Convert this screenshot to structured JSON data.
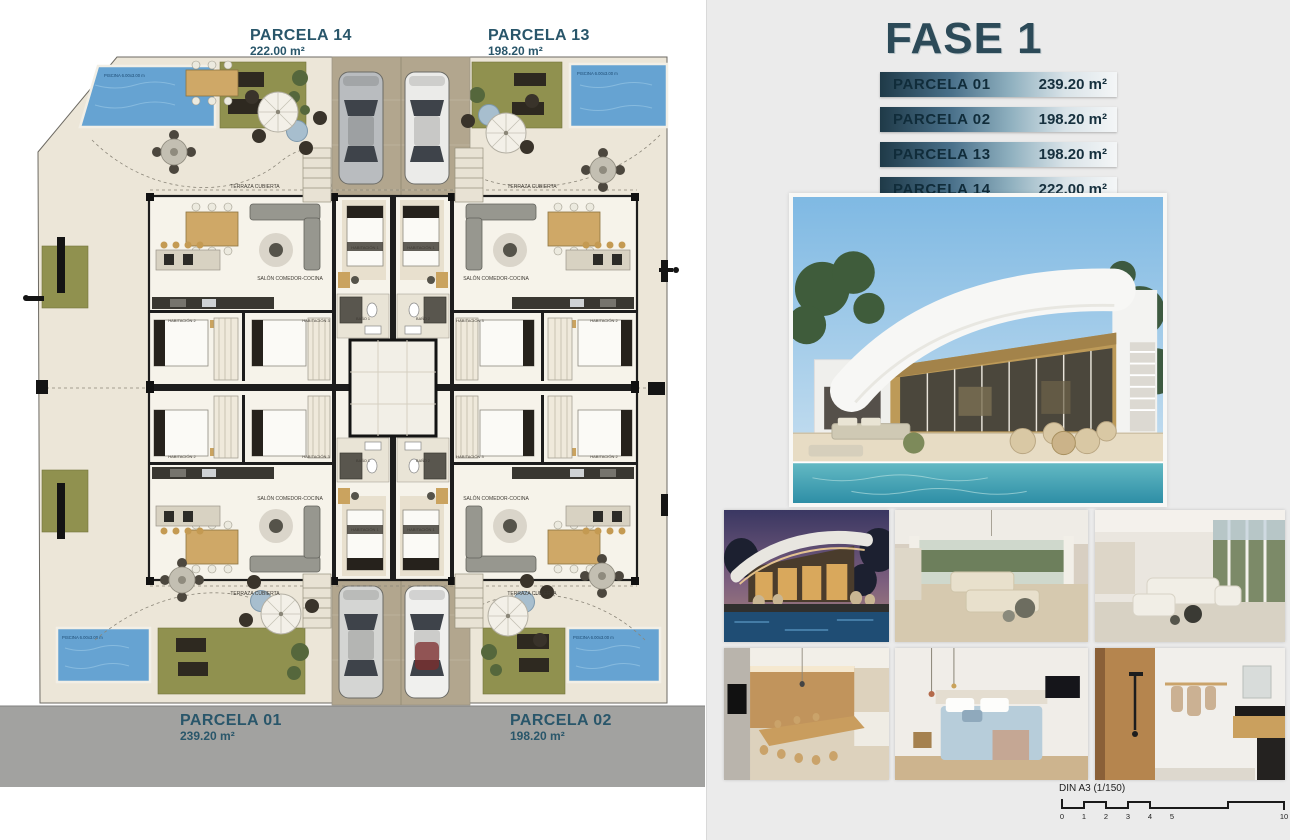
{
  "page": {
    "left_bg": "#ffffff",
    "panel_bg": "#ebebeb"
  },
  "colors": {
    "accent_teal": "#29566a",
    "title_color": "#2c4a58",
    "bar_gradient_start": "#1f3a48",
    "bar_gradient_end": "#f4f6f7",
    "pool": "#66a3d2",
    "grass": "#90914f",
    "terrace": "#ece6d8",
    "road": "#a2a2a0",
    "driveway": "#b2a68e",
    "wall": "#1c1c1c"
  },
  "plan": {
    "top_parcels": [
      {
        "name": "PARCELA 14",
        "area": "222.00 m²"
      },
      {
        "name": "PARCELA 13",
        "area": "198.20 m²"
      }
    ],
    "road_parcels": [
      {
        "name": "PARCELA 01",
        "area": "239.20 m²"
      },
      {
        "name": "PARCELA 02",
        "area": "198.20 m²"
      }
    ],
    "room_labels": {
      "salon": "SALÓN COMEDOR-COCINA",
      "terraza": "TERRAZA CUBIERTA",
      "hab1": "HABITACIÓN 1",
      "hab2": "HABITACIÓN 2",
      "hab3": "HABITACIÓN 3",
      "bano1": "BAÑO 1",
      "bano2": "BAÑO 2",
      "piscina": "PISCINA 6.00x3.00 m"
    }
  },
  "panel": {
    "title": "FASE 1",
    "table": [
      {
        "parcel": "PARCELA 01",
        "area": "239.20 m²"
      },
      {
        "parcel": "PARCELA 02",
        "area": "198.20 m²"
      },
      {
        "parcel": "PARCELA 13",
        "area": "198.20 m²"
      },
      {
        "parcel": "PARCELA 14",
        "area": "222.00 m²"
      }
    ],
    "images": {
      "hero": "villa-exterior-render",
      "thumbs": [
        "night-pool-exterior",
        "terrace-lounge-interior",
        "living-room-interior",
        "kitchen-dining-interior",
        "bedroom-interior",
        "bathroom-interior"
      ]
    }
  },
  "scalebar": {
    "label": "DIN A3 (1/150)",
    "ticks": [
      "0",
      "1",
      "2",
      "3",
      "4",
      "5",
      "10"
    ]
  }
}
